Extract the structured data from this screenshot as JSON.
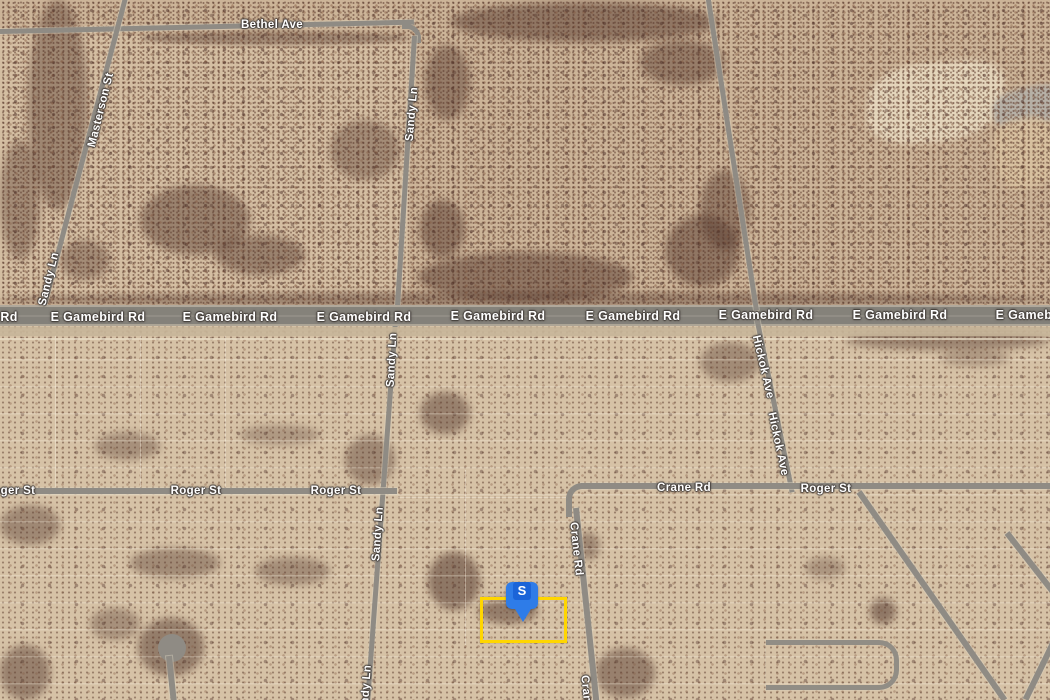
{
  "map": {
    "view": "satellite",
    "description": "Aerial satellite view of desert road grid with highlighted parcel",
    "marker": {
      "label": "S",
      "color": "#2e7ce8",
      "inner_color": "#1b64d8",
      "text_color": "#ffffff"
    },
    "parcel": {
      "outline_color": "#ffd600"
    },
    "roads": [
      "Bethel Ave",
      "Masterson St",
      "Sandy Ln",
      "E Gamebird Rd",
      "Roger St",
      "Crane Rd",
      "Hickok Ave"
    ]
  },
  "labels": [
    {
      "text": "Bethel Ave"
    },
    {
      "text": "Sandy Ln"
    },
    {
      "text": "Masterson St"
    },
    {
      "text": "Sandy Ln"
    },
    {
      "text": "Rd"
    },
    {
      "text": "E Gamebird Rd"
    },
    {
      "text": "E Gamebird Rd"
    },
    {
      "text": "E Gamebird Rd"
    },
    {
      "text": "E Gamebird Rd"
    },
    {
      "text": "E Gamebird Rd"
    },
    {
      "text": "E Gamebird Rd"
    },
    {
      "text": "E Gamebird Rd"
    },
    {
      "text": "E Gamebird Rd"
    },
    {
      "text": "Sandy Ln"
    },
    {
      "text": "Hickok Ave"
    },
    {
      "text": "Hickok Ave"
    },
    {
      "text": "Roger St"
    },
    {
      "text": "Roger St"
    },
    {
      "text": "Roger St"
    },
    {
      "text": "Crane Rd"
    },
    {
      "text": "Roger St"
    },
    {
      "text": "Sandy Ln"
    },
    {
      "text": "Crane Rd"
    },
    {
      "text": "Sandy Ln"
    },
    {
      "text": "Crane Rd"
    }
  ]
}
